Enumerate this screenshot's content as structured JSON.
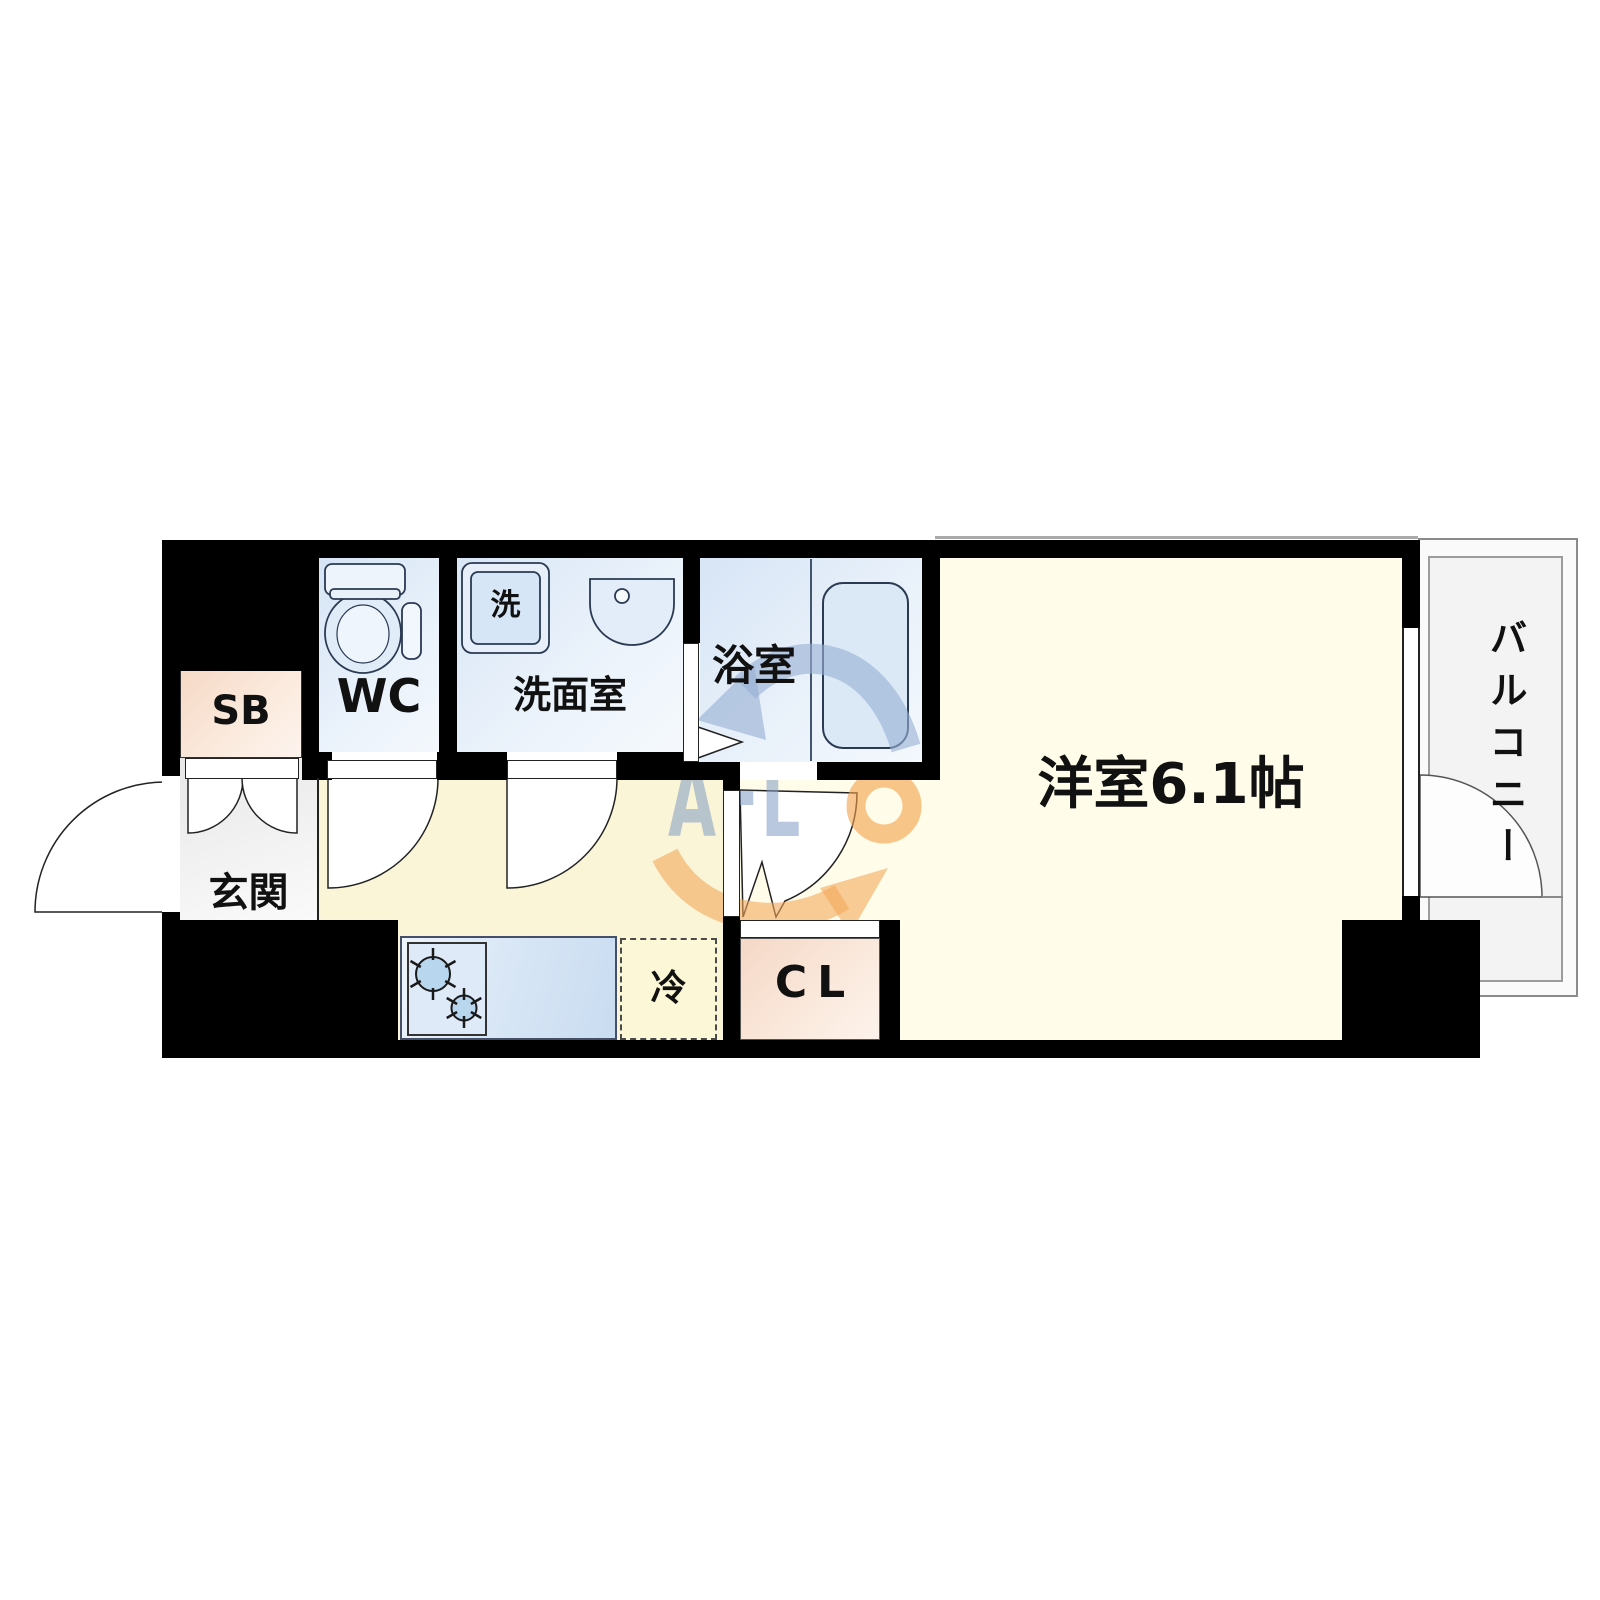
{
  "floor_plan": {
    "rooms": {
      "western_room": "洋室6.1帖",
      "balcony": "バルコニー",
      "bathroom": "浴室",
      "washroom": "洗面室",
      "toilet": "WC",
      "shoe_box": "SB",
      "entrance": "玄関",
      "closet": "CL",
      "refrigerator": "冷",
      "washer_mark": "洗"
    },
    "watermark": {
      "blue_text": "AFL",
      "orange_letter": "O"
    },
    "colors": {
      "wall": "#000000",
      "main_room_floor": "#fffce9",
      "corridor_floor": "#fbf5d8",
      "wet_area_blue": "#d8e6f6",
      "closet_peach": "#f5d8c6",
      "entrance_gray": "#ededed",
      "balcony_gray": "#f3f3f3",
      "watermark_blue": "#8ca5c8",
      "watermark_orange": "#f3a050"
    }
  }
}
